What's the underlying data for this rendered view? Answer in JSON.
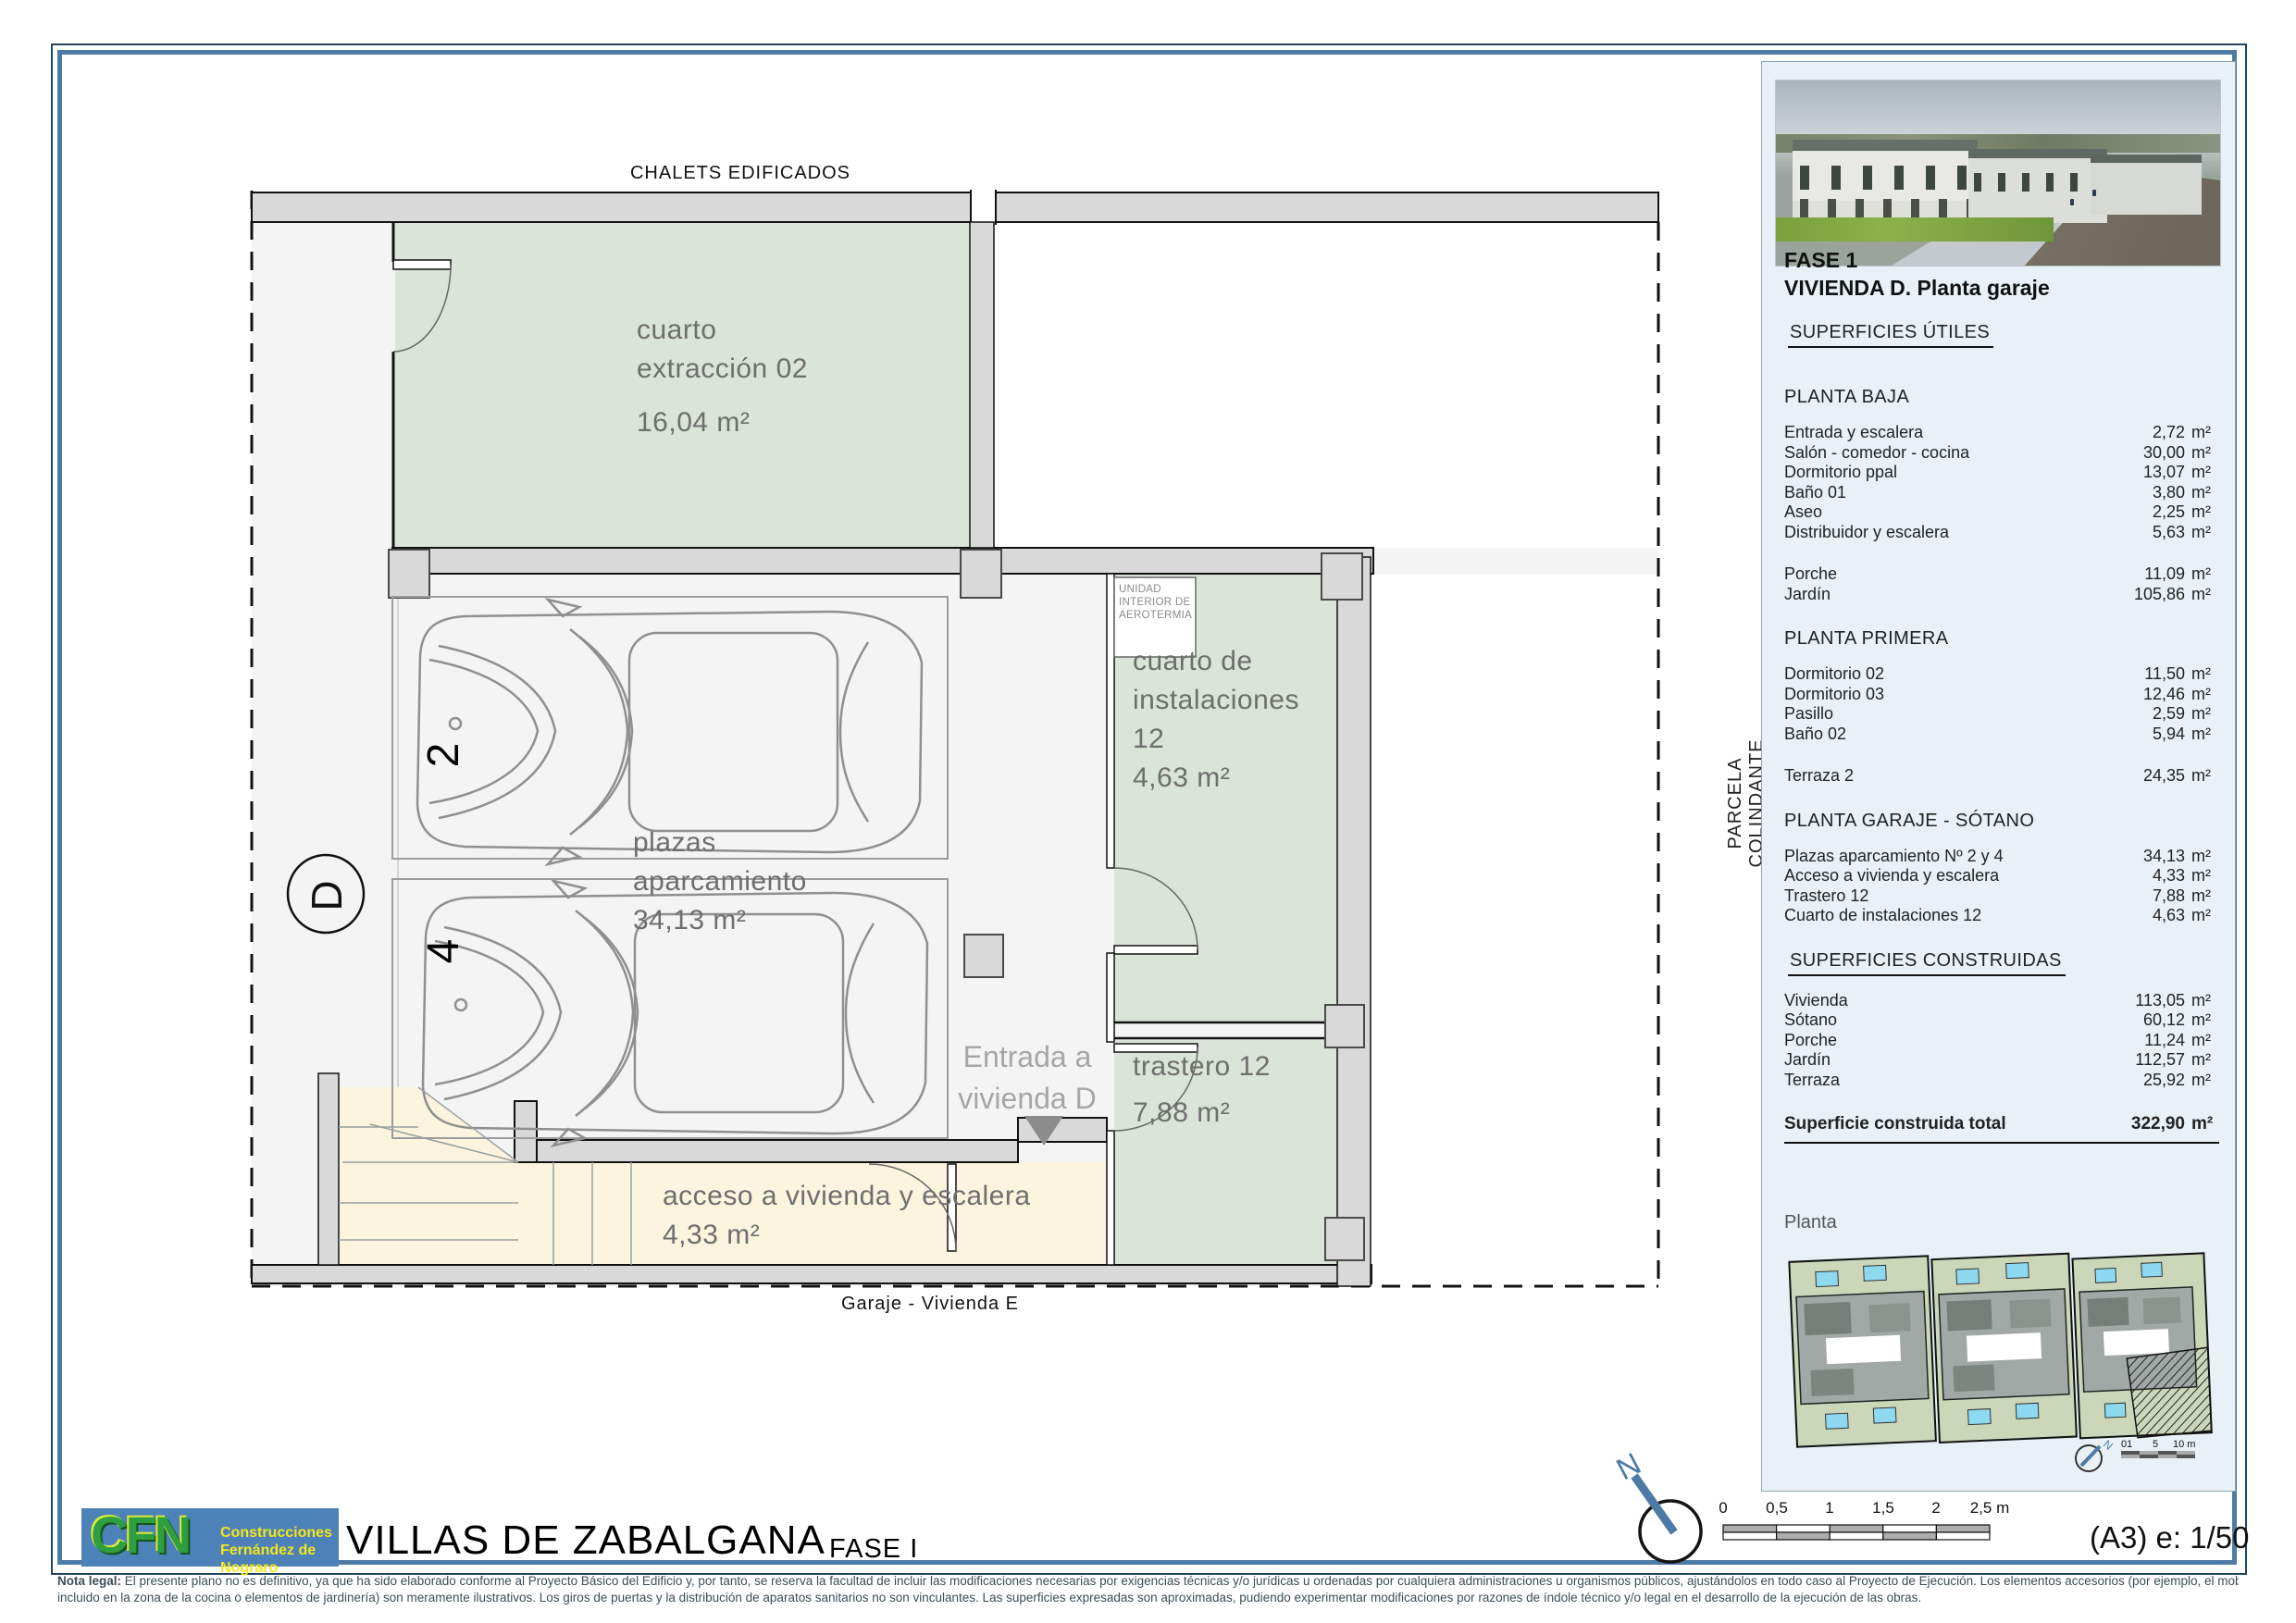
{
  "colors": {
    "accent_blue": "#4d7ba6",
    "sage_room": "#dbe4d8",
    "beige_room": "#fcf4df",
    "wall_gray": "#d9d9d9",
    "floor_gray": "#f4f4f4",
    "room_label_gray": "#6e6e6e",
    "logo_blue": "#4d82b8",
    "logo_green": "#2f9e3e",
    "logo_yellow": "#f5e61a"
  },
  "plan": {
    "top_context_label": "CHALETS EDIFICADOS",
    "bottom_context_label": "Garaje - Vivienda E",
    "side_context_label": "PARCELA COLINDANTE",
    "unit_letter": "D",
    "rooms": {
      "extraccion": {
        "lines": [
          "cuarto",
          "extracción 02"
        ],
        "area": "16,04 m²"
      },
      "instalaciones": {
        "lines": [
          "cuarto de",
          "instalaciones",
          "12"
        ],
        "area": "4,63 m²"
      },
      "trastero": {
        "lines": [
          "trastero 12"
        ],
        "area": "7,88 m²"
      },
      "acceso": {
        "lines": [
          "acceso a vivienda y escalera"
        ],
        "area": "4,33 m²"
      },
      "parking": {
        "lines": [
          "plazas",
          "aparcamiento"
        ],
        "area": "34,13 m²",
        "spot_numbers": [
          "2",
          "4"
        ]
      }
    },
    "entrada_note": {
      "lines": [
        "Entrada a",
        "vivienda D"
      ]
    },
    "aerotermia_note": {
      "lines": [
        "UNIDAD",
        "INTERIOR DE",
        "AEROTERMIA"
      ]
    }
  },
  "sidebar": {
    "fase": "FASE 1",
    "title": "VIVIENDA D. Planta garaje",
    "sections": [
      {
        "title": "SUPERFICIES ÚTILES",
        "underline": true,
        "groups": []
      },
      {
        "title": "PLANTA BAJA",
        "underline": false,
        "groups": [
          [
            {
              "label": "Entrada y escalera",
              "value": "2,72",
              "unit": "m²"
            },
            {
              "label": "Salón - comedor - cocina",
              "value": "30,00",
              "unit": "m²"
            },
            {
              "label": "Dormitorio ppal",
              "value": "13,07",
              "unit": "m²"
            },
            {
              "label": "Baño 01",
              "value": "3,80",
              "unit": "m²"
            },
            {
              "label": "Aseo",
              "value": "2,25",
              "unit": "m²"
            },
            {
              "label": "Distribuidor y escalera",
              "value": "5,63",
              "unit": "m²"
            }
          ],
          [
            {
              "label": "Porche",
              "value": "11,09",
              "unit": "m²"
            },
            {
              "label": "Jardín",
              "value": "105,86",
              "unit": "m²"
            }
          ]
        ]
      },
      {
        "title": "PLANTA PRIMERA",
        "underline": false,
        "groups": [
          [
            {
              "label": "Dormitorio 02",
              "value": "11,50",
              "unit": "m²"
            },
            {
              "label": "Dormitorio 03",
              "value": "12,46",
              "unit": "m²"
            },
            {
              "label": "Pasillo",
              "value": "2,59",
              "unit": "m²"
            },
            {
              "label": "Baño 02",
              "value": "5,94",
              "unit": "m²"
            }
          ],
          [
            {
              "label": "Terraza 2",
              "value": "24,35",
              "unit": "m²"
            }
          ]
        ]
      },
      {
        "title": "PLANTA GARAJE - SÓTANO",
        "underline": false,
        "groups": [
          [
            {
              "label": "Plazas aparcamiento Nº 2 y 4",
              "value": "34,13",
              "unit": "m²"
            },
            {
              "label": "Acceso a vivienda y escalera",
              "value": "4,33",
              "unit": "m²"
            },
            {
              "label": "Trastero 12",
              "value": "7,88",
              "unit": "m²"
            },
            {
              "label": "Cuarto de instalaciones  12",
              "value": "4,63",
              "unit": "m²"
            }
          ]
        ]
      },
      {
        "title": "SUPERFICIES CONSTRUIDAS",
        "underline": true,
        "groups": [
          [
            {
              "label": "Vivienda",
              "value": "113,05",
              "unit": "m²"
            },
            {
              "label": "Sótano",
              "value": "60,12",
              "unit": "m²"
            },
            {
              "label": "Porche",
              "value": "11,24",
              "unit": "m²"
            },
            {
              "label": "Jardín",
              "value": "112,57",
              "unit": "m²"
            },
            {
              "label": "Terraza",
              "value": "25,92",
              "unit": "m²"
            }
          ]
        ]
      }
    ],
    "total": {
      "label": "Superficie construida total",
      "value": "322,90",
      "unit": "m²"
    },
    "planta_label": "Planta",
    "minimap": {
      "north": "N",
      "scale_ticks": [
        "01",
        "5",
        "10 m"
      ]
    }
  },
  "footer": {
    "logo": {
      "letters": "CFN",
      "lines": [
        "Construcciones",
        "Fernández de Nograro"
      ]
    },
    "project": "VILLAS DE ZABALGANA",
    "fase": "FASE I",
    "north": "N",
    "scalebar": {
      "ticks": [
        "0",
        "0,5",
        "1",
        "1,5",
        "2",
        "2,5 m"
      ]
    },
    "sheet_scale": "(A3) e: 1/50"
  },
  "legal": {
    "label": "Nota legal:",
    "line1": " El presente plano no es definitivo, ya que ha sido elaborado conforme al Proyecto Básico del Edificio y, por tanto, se reserva la facultad de incluir las modificaciones necesarias por exigencias técnicas y/o jurídicas u ordenadas por cualquiera administraciones u organismos públicos, ajustándolos en todo caso al Proyecto de Ejecución. Los elementos accesorios (por ejemplo, el mobiliario",
    "line2": "incluido en la zona de la cocina o elementos de jardinería) son meramente ilustrativos. Los giros de puertas y la distribución de aparatos sanitarios no son vinculantes. Las superficies expresadas son aproximadas, pudiendo experimentar modificaciones por razones de índole técnico y/o legal en el desarrollo de la ejecución de las obras."
  }
}
